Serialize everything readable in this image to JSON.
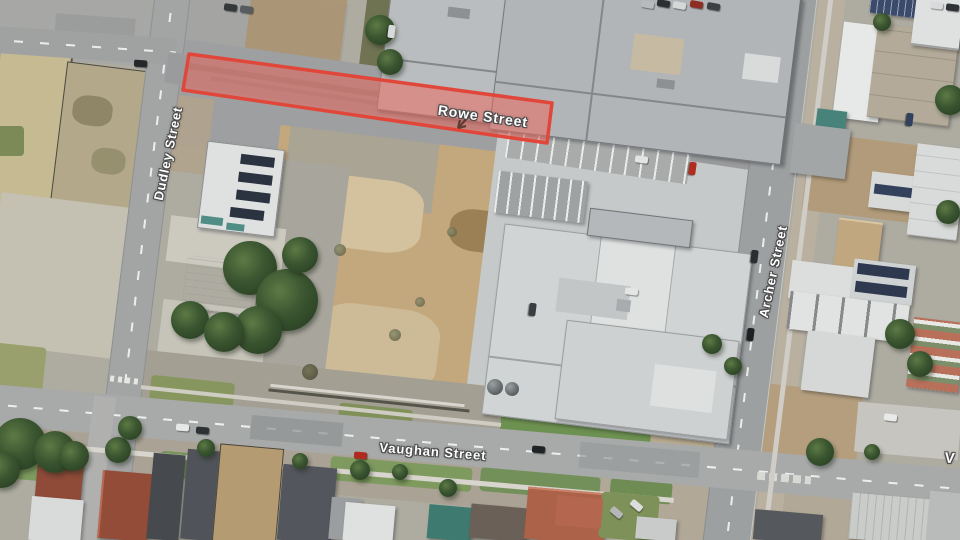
{
  "map": {
    "kind": "aerial-satellite-imagery",
    "streets": {
      "dudley": {
        "label": "Dudley Street"
      },
      "rowe": {
        "label": "Rowe Street"
      },
      "archer": {
        "label": "Archer Street"
      },
      "vaughan": {
        "label": "Vaughan Street"
      },
      "vaughan_right_partial": {
        "label": "V"
      }
    },
    "highlight": {
      "points": "189,54 552,103 547,143 183,90",
      "fill": "rgba(240,100,88,0.5)",
      "stroke": "#e0473a",
      "stroke_width": "3.5"
    },
    "label_style": {
      "color": "#ffffff",
      "outline": "#4a4a4a"
    }
  }
}
